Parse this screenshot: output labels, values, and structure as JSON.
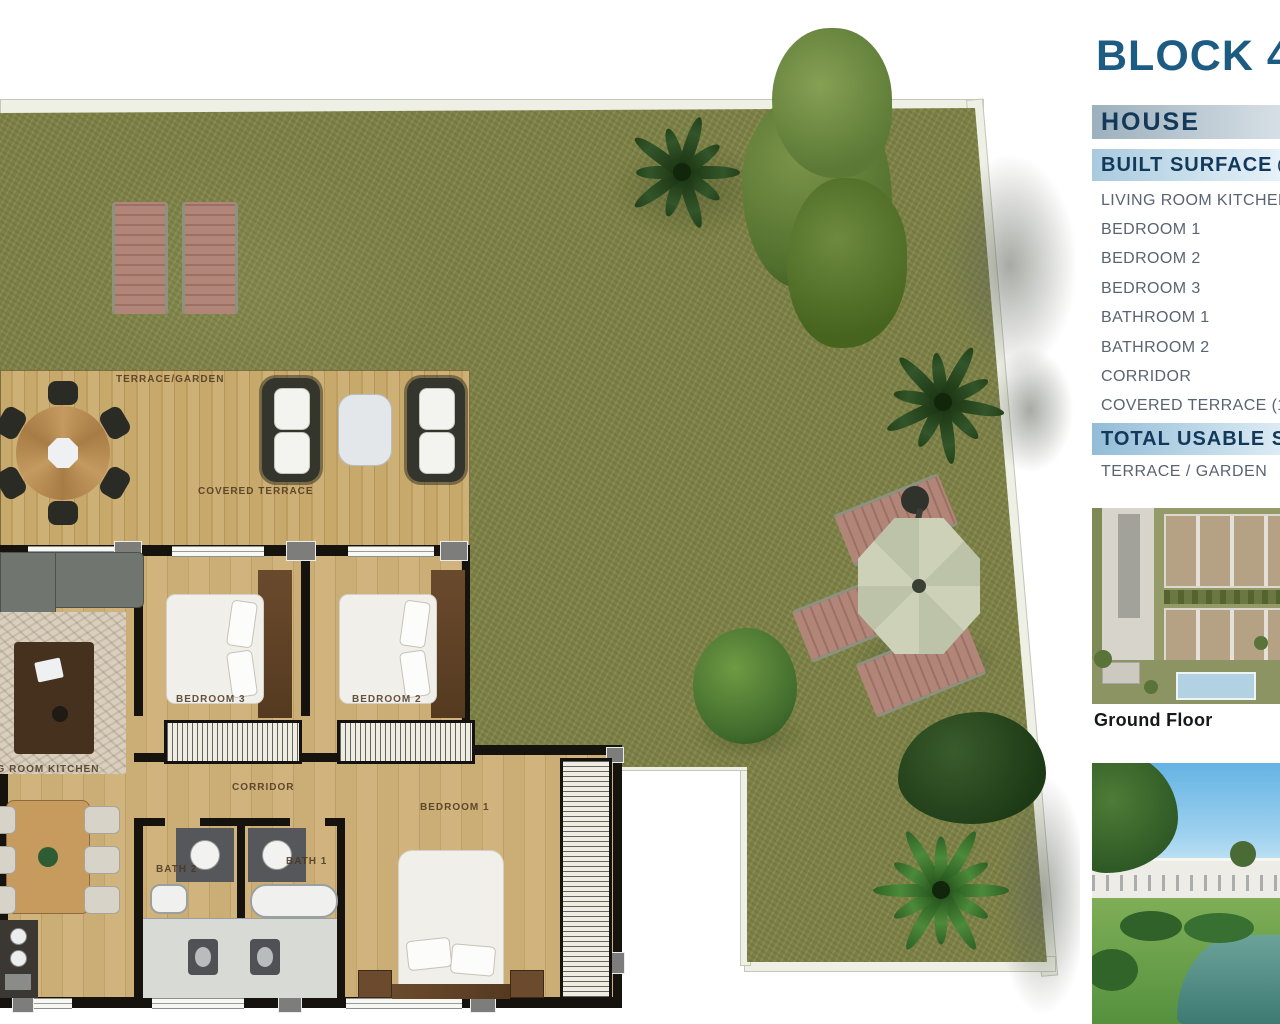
{
  "plan": {
    "labels": {
      "terrace_garden": "TERRACE/GARDEN",
      "covered_terrace": "COVERED TERRACE",
      "bedroom3": "BEDROOM 3",
      "bedroom2": "BEDROOM 2",
      "bedroom1": "BEDROOM 1",
      "corridor": "CORRIDOR",
      "living_room_kitchen": "LIVING ROOM KITCHEN",
      "bath1": "BATH 1",
      "bath2": "BATH 2"
    }
  },
  "sidebar": {
    "block_title": "BLOCK 4",
    "house_label": "HOUSE",
    "built_surface_label": "BUILT SURFACE",
    "built_surface_note": "(Terra",
    "rooms": [
      "LIVING ROOM KITCHEN",
      "BEDROOM 1",
      "BEDROOM 2",
      "BEDROOM 3",
      "BATHROOM 1",
      "BATHROOM 2",
      "CORRIDOR",
      "COVERED TERRACE (10"
    ],
    "total_usable_label": "TOTAL USABLE SUR",
    "terrace_garden_label": "TERRACE / GARDEN",
    "ground_floor_label": "Ground Floor"
  },
  "colors": {
    "accent_blue": "#1d5c82",
    "bar_text_navy": "#12395a",
    "grass_green": "#7d8147",
    "deck_wood": "#c2a368",
    "floor_wood": "#c7a972",
    "wall_black": "#16120e",
    "list_text_gray": "#5a6470"
  }
}
